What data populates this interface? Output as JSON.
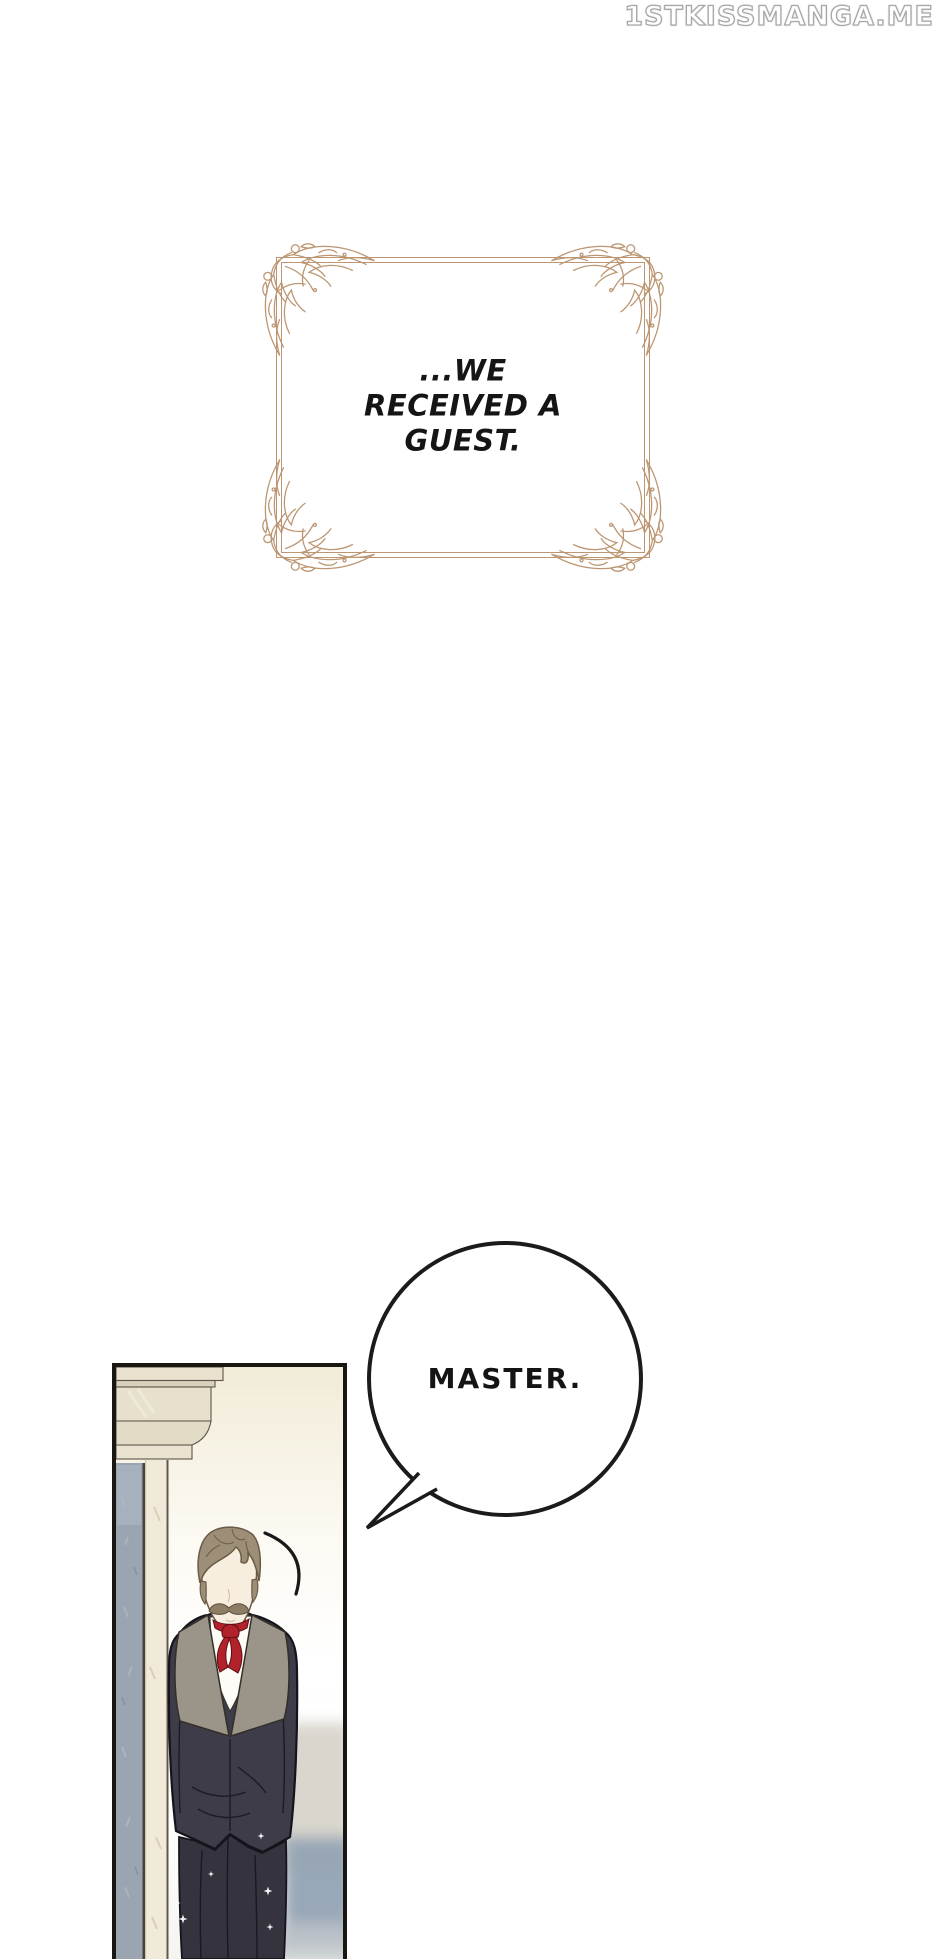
{
  "site_watermark": {
    "text": "1STKISSMANGA.ME"
  },
  "narration_box": {
    "lines": [
      "...WE",
      "RECEIVED A",
      "GUEST."
    ]
  },
  "speech_bubble": {
    "text": "MASTER."
  },
  "colors": {
    "frame_tan": "#bc9672",
    "watermark_outline": "#a8a8a8",
    "panel_border": "#181712",
    "bubble_outline": "#1b1b1b",
    "bg_cream": "#f1ebd8",
    "cornice_beige": "#e7e0cc",
    "jamb_cream": "#f1ead9",
    "mirror_blue": "#9aa5b1",
    "suit": "#3d3c48",
    "suit_dark": "#34333e",
    "lapel": "#9b9489",
    "shirt": "#fdfcf7",
    "ribbon_red": "#b2222b",
    "hair": "#9c8e77",
    "skin": "#f8eedf",
    "mustache": "#8d7d65",
    "blur_blue": "#93a3b4"
  }
}
